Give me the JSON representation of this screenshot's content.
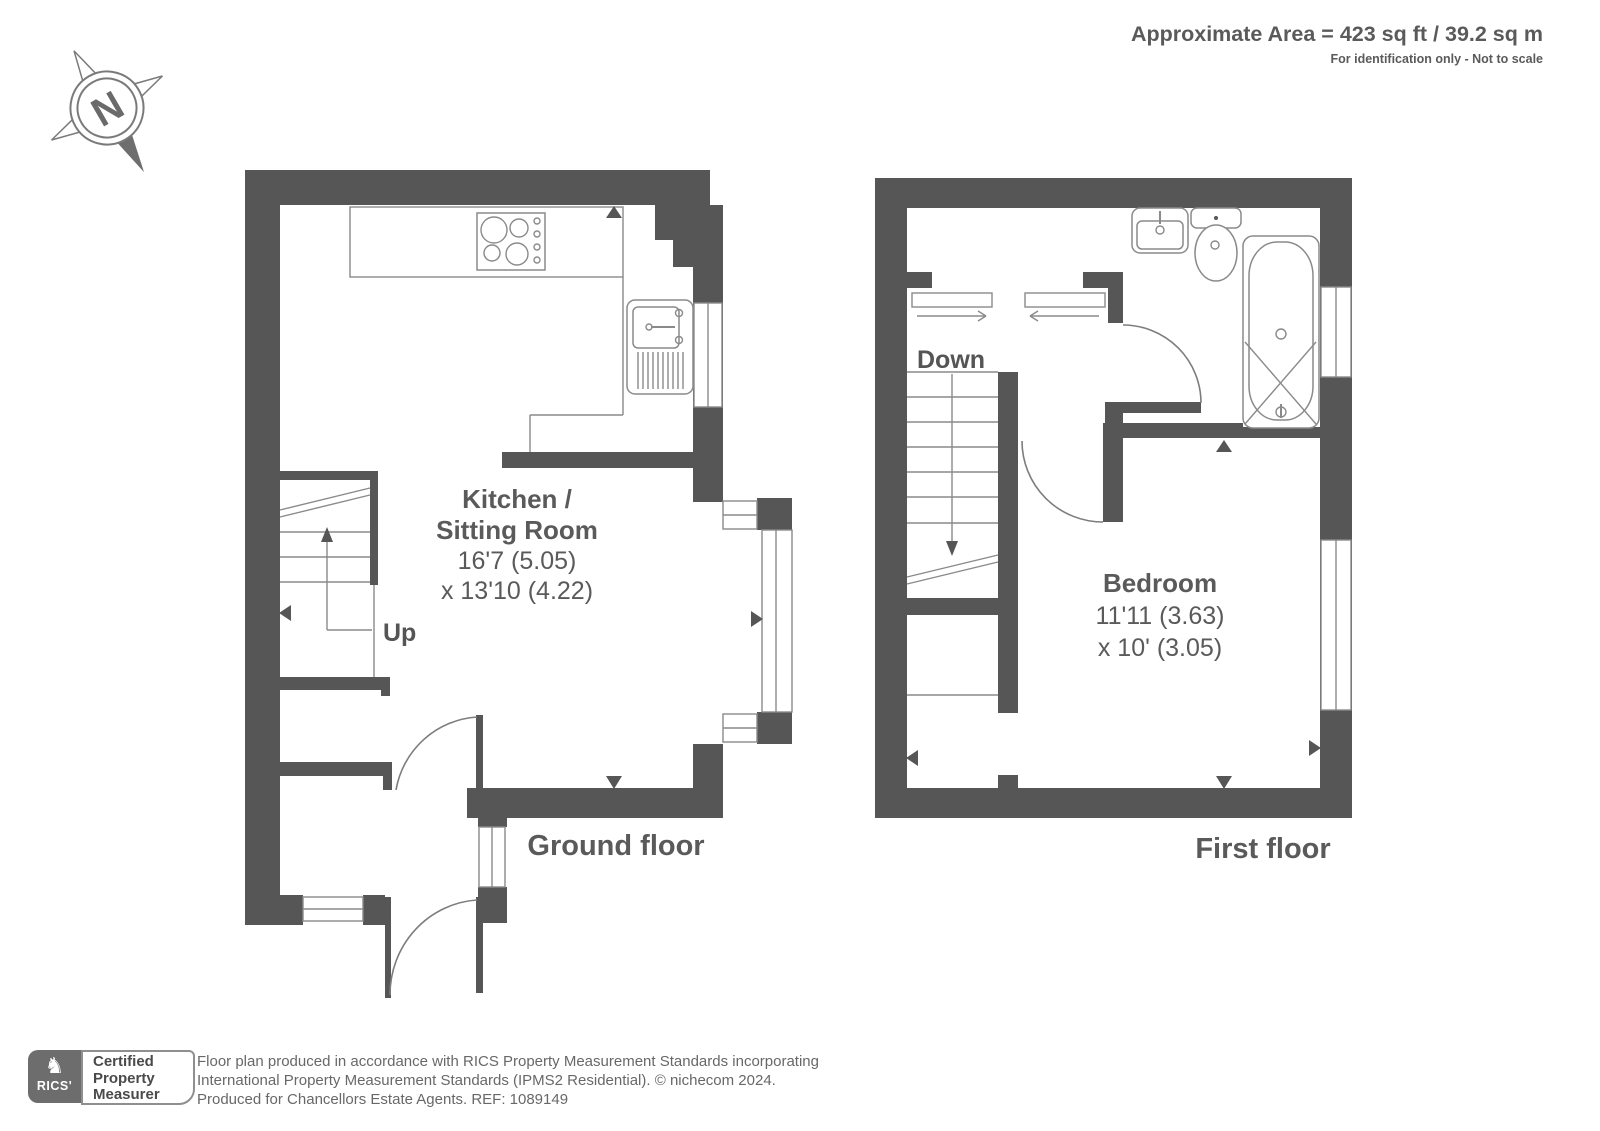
{
  "header": {
    "area": "Approximate Area = 423 sq ft / 39.2 sq m",
    "note": "For identification only - Not to scale"
  },
  "compass": {
    "north": "N"
  },
  "ground_floor": {
    "caption": "Ground floor",
    "room": {
      "name_line1": "Kitchen /",
      "name_line2": "Sitting Room",
      "dims_line1": "16'7 (5.05)",
      "dims_line2": "x 13'10 (4.22)"
    },
    "stairs_label": "Up"
  },
  "first_floor": {
    "caption": "First floor",
    "room": {
      "name": "Bedroom",
      "dims_line1": "11'11 (3.63)",
      "dims_line2": "x 10' (3.05)"
    },
    "stairs_label": "Down"
  },
  "footer": {
    "rics": "RICS'",
    "rics_lion_icon": "♞",
    "badge": [
      "Certified",
      "Property",
      "Measurer"
    ],
    "lines": [
      "Floor plan produced in accordance with RICS Property Measurement Standards incorporating",
      "International Property Measurement Standards (IPMS2 Residential).    © nichecom 2024.",
      "Produced for Chancellors Estate Agents.   REF: 1089149"
    ]
  },
  "colors": {
    "wall": "#565656",
    "line": "#8a8a8a",
    "text": "#5a5a5a"
  }
}
